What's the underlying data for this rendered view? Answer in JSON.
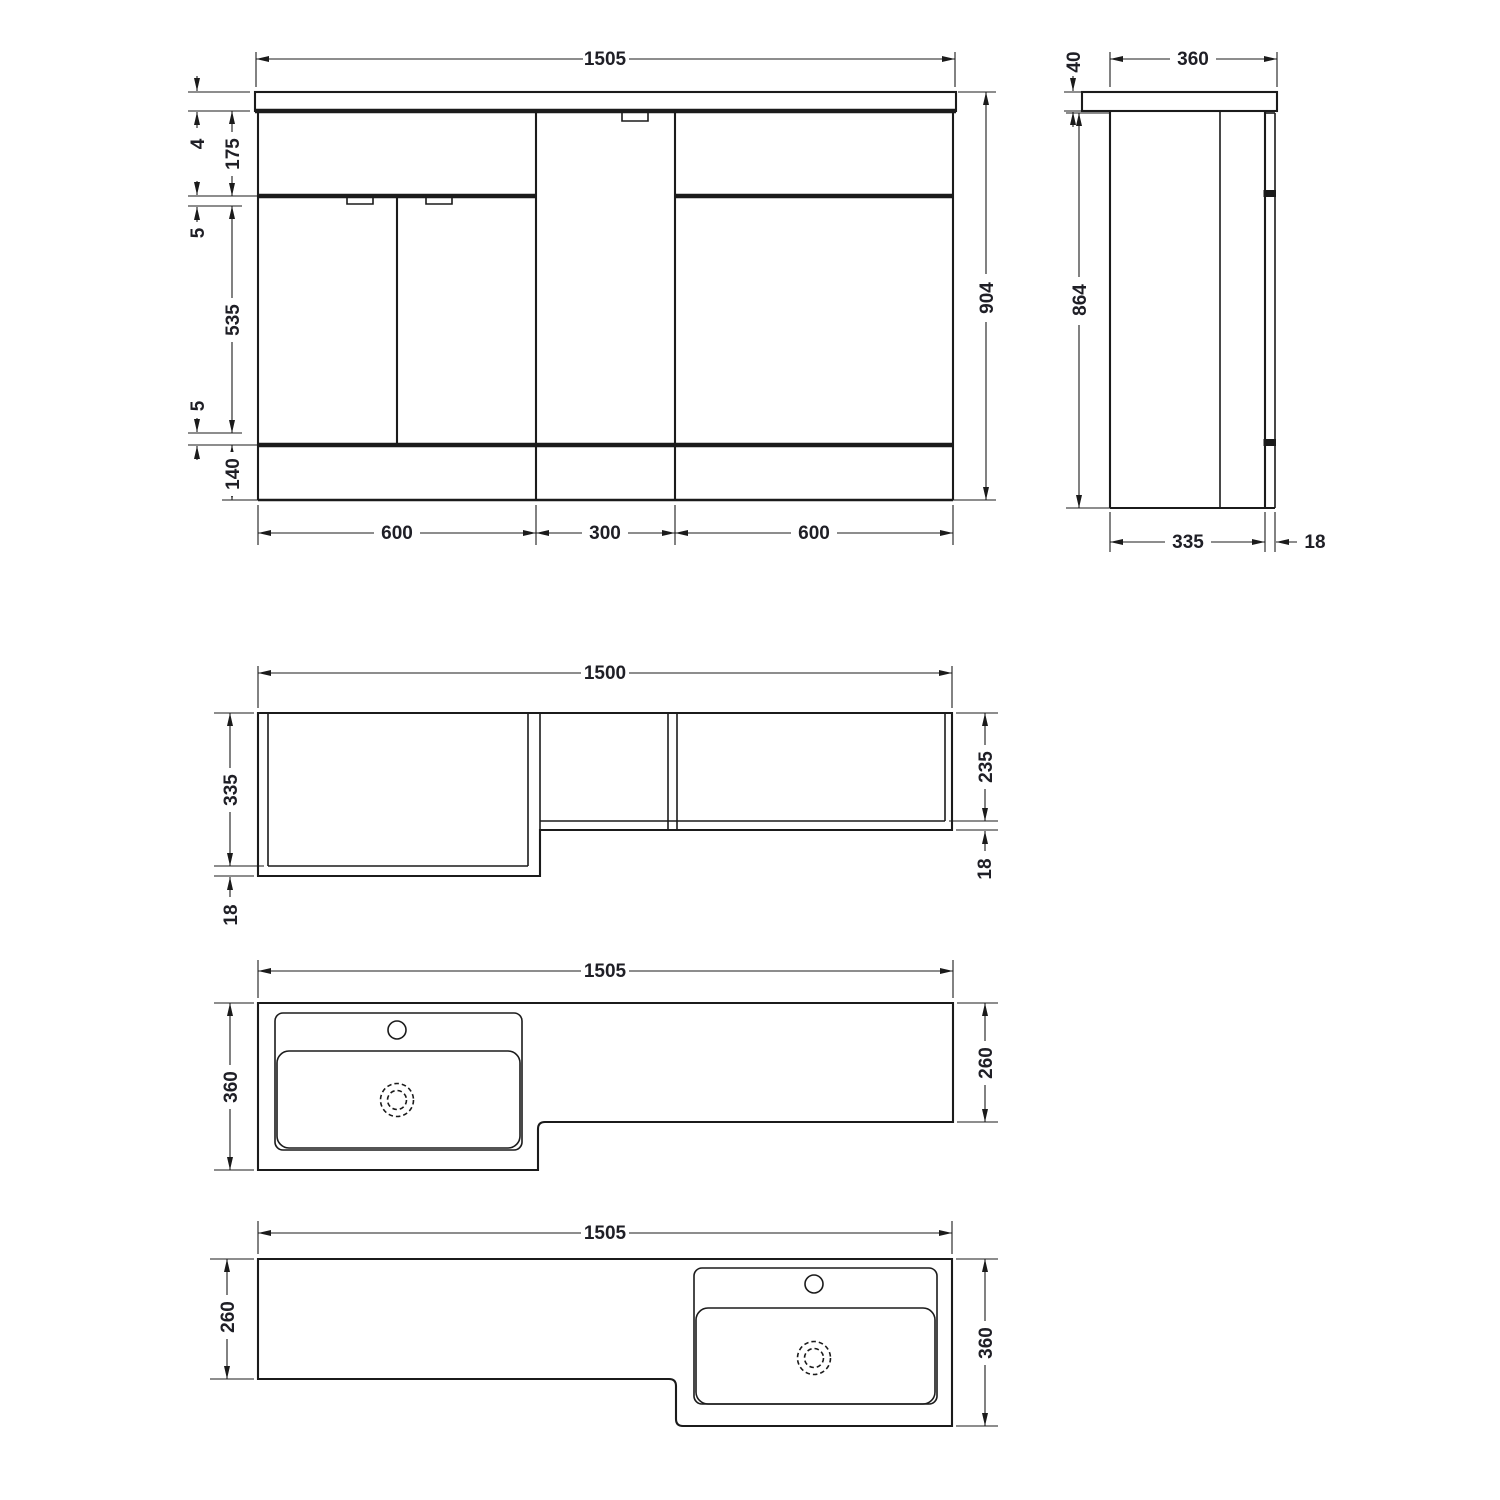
{
  "colors": {
    "line": "#1b1b1b",
    "text": "#1f1f26",
    "background": "#ffffff"
  },
  "views": {
    "front_elevation": {
      "overall_width": "1505",
      "overall_height": "904",
      "top_gap": "4",
      "upper_panel": "175",
      "upper_gap": "5",
      "door_height": "535",
      "lower_gap": "5",
      "plinth_height": "140",
      "left_unit_width": "600",
      "mid_unit_width": "300",
      "right_unit_width": "600"
    },
    "side_elevation": {
      "counter_depth": "360",
      "counter_thickness": "40",
      "carcass_height": "864",
      "carcass_depth": "335",
      "front_panel": "18"
    },
    "plan_view": {
      "overall_width": "1500",
      "left_depth": "335",
      "left_front_panel": "18",
      "right_depth": "235",
      "right_front_panel": "18"
    },
    "counter_plan_lh": {
      "overall_width": "1505",
      "basin_side_depth": "360",
      "slim_side_depth": "260"
    },
    "counter_plan_rh": {
      "overall_width": "1505",
      "slim_side_depth": "260",
      "basin_side_depth": "360"
    }
  }
}
